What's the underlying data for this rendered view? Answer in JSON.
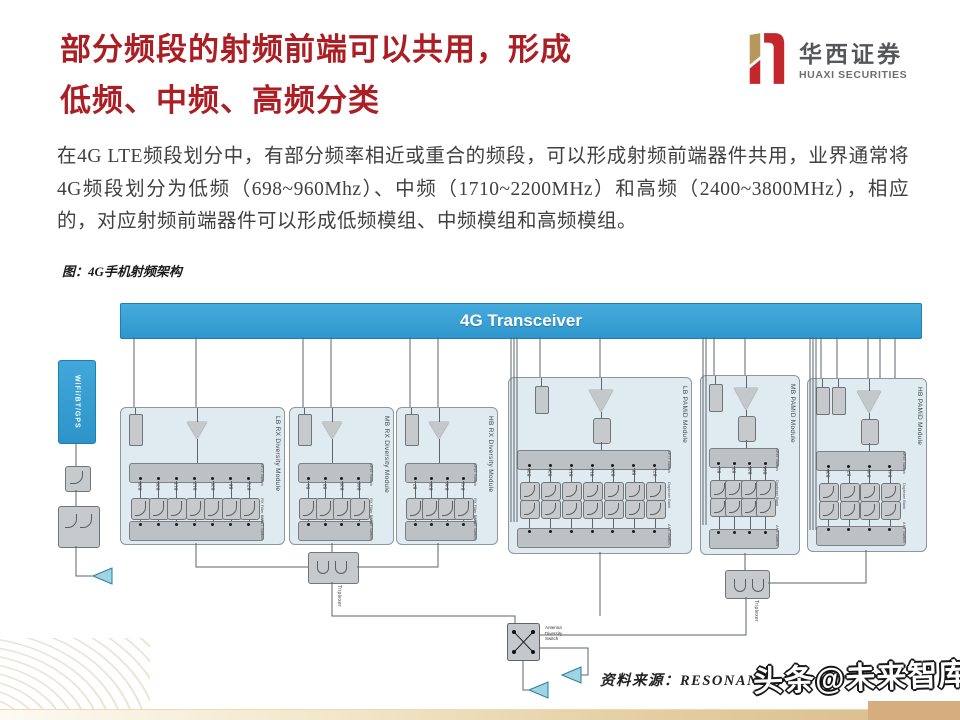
{
  "meta": {
    "title_line1": "部分频段的射频前端可以共用，形成",
    "title_line2": "低频、中频、高频分类"
  },
  "logo": {
    "cn": "华西证券",
    "en": "HUAXI SECURITIES"
  },
  "body": {
    "text": "在4G LTE频段划分中，有部分频率相近或重合的频段，可以形成射频前端器件共用，业界通常将4G频段划分为低频（698~960Mhz）、中频（1710~2200MHz）和高频（2400~3800MHz），相应的，对应射频前端器件可以形成低频模组、中频模组和高频模组。"
  },
  "figure": {
    "caption": "图：4G手机射频架构"
  },
  "footer": {
    "source": "资料来源：RESONANT ，",
    "watermark": "头条@未来智库"
  },
  "colors": {
    "title_red": "#ab1f24",
    "logo_gold": "#b5985a",
    "logo_red": "#c3262b",
    "transceiver_blue": "#3aa3d8",
    "module_bg": "#e0ebf1",
    "accent_tan": "#d8bc8a"
  },
  "diagram": {
    "transceiver": "4G Transceiver",
    "wifi": "WiFi/BT/GPS",
    "triplexer": "Triplexer",
    "antenna_switch": "Antenna\nDiversity\nSwitch",
    "modules": [
      {
        "label": "LB RX Diversity Module",
        "type": "rx",
        "top_switch": "SP7T Switch",
        "filters_label": "RX Filter Bank",
        "bottom_switch": "SP7T Switch",
        "bands": [
          "B28",
          "B20",
          "B13",
          "B12",
          "B26",
          "B8",
          "B71"
        ]
      },
      {
        "label": "MB RX Diversity Module",
        "type": "rx",
        "top_switch": "SP4T Switch",
        "filters_label": "RX Filter Bank",
        "bottom_switch": "SP4T Switch",
        "bands": [
          "B1",
          "B3",
          "B25",
          "B66"
        ]
      },
      {
        "label": "HB RX Diversity Module",
        "type": "rx",
        "top_switch": "SP4T Switch",
        "filters_label": "RX Filter Bank",
        "bottom_switch": "SP4T Switch",
        "bands": [
          "B7",
          "B30",
          "B40",
          "B41"
        ]
      },
      {
        "label": "LB PAMiD Module",
        "type": "pamid",
        "top_switch": "SP7T Switch",
        "filters_label": "Duplexer Bank",
        "bottom_switch": "ANT Switch",
        "bands": [
          "B28",
          "B20",
          "B13",
          "B12",
          "B26",
          "B8",
          "B71"
        ]
      },
      {
        "label": "MB PAMiD Module",
        "type": "pamid",
        "top_switch": "SP4T Switch",
        "filters_label": "Duplexer Bank",
        "bottom_switch": "ANT Switch",
        "bands": [
          "B1",
          "B3",
          "B25",
          "B66"
        ]
      },
      {
        "label": "HB PAMiD Module",
        "type": "pamid",
        "top_switch": "SP4T Switch",
        "filters_label": "Duplexer Bank",
        "bottom_switch": "ANT Switch",
        "bands": [
          "B30",
          "B7",
          "B40",
          "B41"
        ]
      }
    ]
  }
}
